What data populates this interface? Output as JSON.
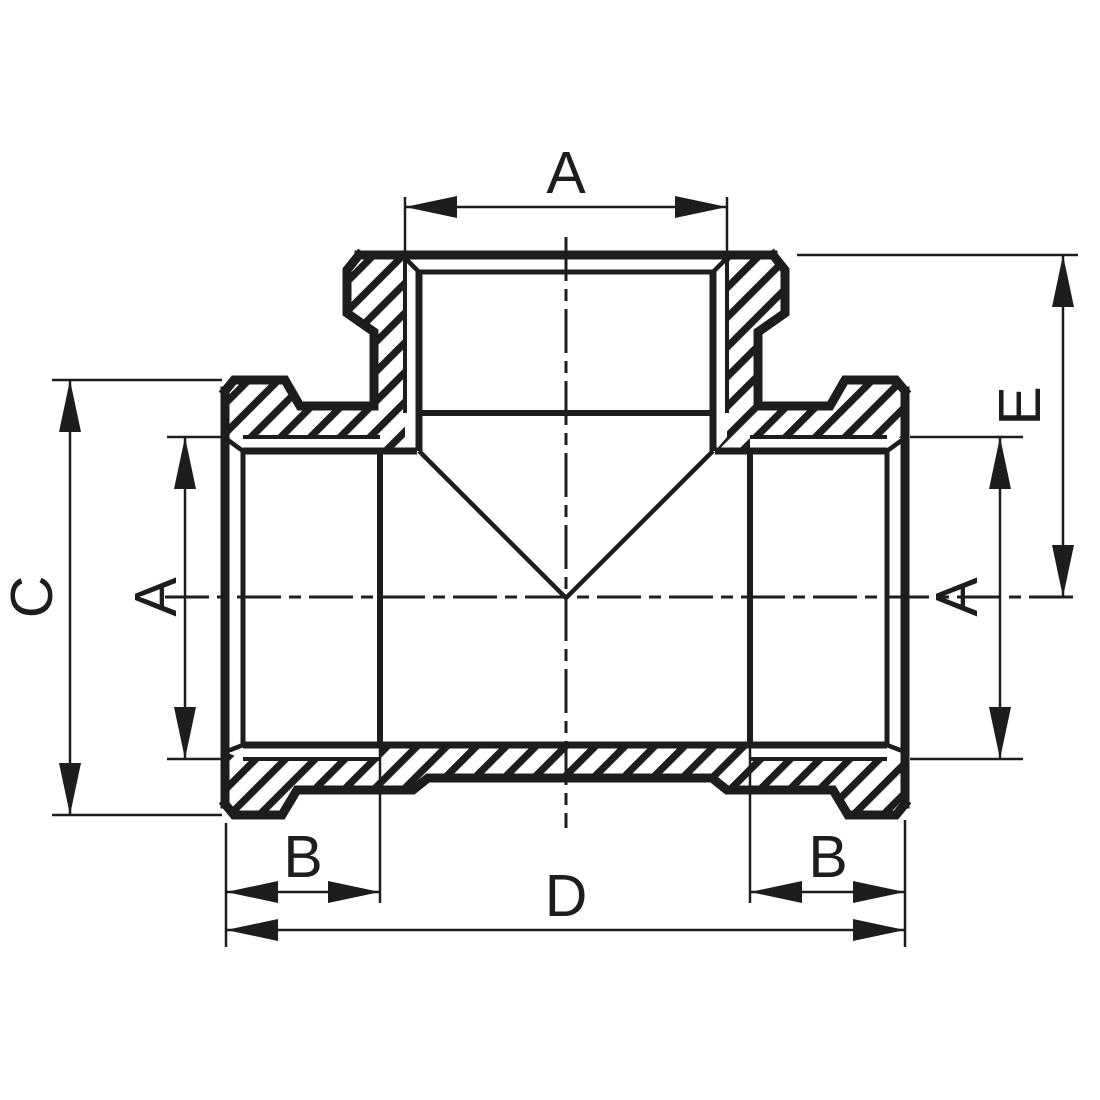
{
  "drawing": {
    "title": "Threaded tee pipe fitting cross-section dimensional drawing",
    "background_color": "#ffffff",
    "line_color": "#1d1d1b",
    "dimension_labels": {
      "top_thread_diameter": "A",
      "left_thread_diameter": "A",
      "right_thread_diameter": "A",
      "left_overall_height": "C",
      "branch_center_depth": "E",
      "left_thread_length": "B",
      "right_thread_length": "B",
      "overall_length": "D"
    }
  }
}
